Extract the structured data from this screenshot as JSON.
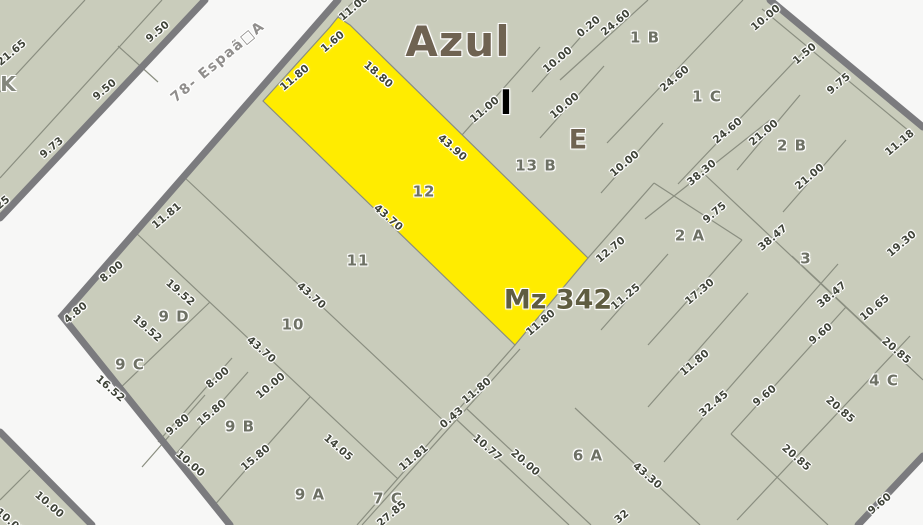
{
  "map": {
    "city_label": "Azul",
    "block_label": "Mz 342",
    "street_name": "78- Espaã□A",
    "highlighted_parcel": "12",
    "colors": {
      "parcel_fill": "#c9ccbb",
      "highlight_parcel": "#ffec00",
      "road_casing": "#7b7b7e",
      "parcel_line": "#8a8e80",
      "street_bg": "#f7f7f6",
      "dimension_text": "#3f4338",
      "title_text": "#6f6352"
    }
  },
  "labels": [
    {
      "name": "city-title",
      "text": "Azul"
    },
    {
      "name": "block-number",
      "text": "Mz 342"
    },
    {
      "name": "street-name",
      "text": "78- Espaã□A"
    },
    {
      "name": "zone-letter-i",
      "text": "I"
    },
    {
      "name": "zone-letter-e",
      "text": "E"
    },
    {
      "name": "zone-letter-k",
      "text": "K"
    },
    {
      "name": "parcel-12",
      "text": "12"
    },
    {
      "name": "parcel-11",
      "text": "11"
    },
    {
      "name": "parcel-10",
      "text": "10"
    },
    {
      "name": "parcel-9d",
      "text": "9 D"
    },
    {
      "name": "parcel-9c",
      "text": "9 C"
    },
    {
      "name": "parcel-9b",
      "text": "9 B"
    },
    {
      "name": "parcel-9a",
      "text": "9 A"
    },
    {
      "name": "parcel-7c",
      "text": "7 C"
    },
    {
      "name": "parcel-6a",
      "text": "6 A"
    },
    {
      "name": "parcel-13b",
      "text": "13 B"
    },
    {
      "name": "parcel-1b",
      "text": "1 B"
    },
    {
      "name": "parcel-1c",
      "text": "1 C"
    },
    {
      "name": "parcel-2b",
      "text": "2 B"
    },
    {
      "name": "parcel-2a",
      "text": "2 A"
    },
    {
      "name": "parcel-3",
      "text": "3"
    },
    {
      "name": "parcel-4c",
      "text": "4 C"
    },
    {
      "name": "dim",
      "text": "9.50"
    },
    {
      "name": "dim",
      "text": "9.50"
    },
    {
      "name": "dim",
      "text": "21.65"
    },
    {
      "name": "dim",
      "text": "9.73"
    },
    {
      "name": "dim",
      "text": "25"
    },
    {
      "name": "dim",
      "text": "11.00"
    },
    {
      "name": "dim",
      "text": "1.60"
    },
    {
      "name": "dim",
      "text": "11.80"
    },
    {
      "name": "dim",
      "text": "18.80"
    },
    {
      "name": "dim",
      "text": "43.90"
    },
    {
      "name": "dim",
      "text": "11.00"
    },
    {
      "name": "dim",
      "text": "10.00"
    },
    {
      "name": "dim",
      "text": "10.00"
    },
    {
      "name": "dim",
      "text": "0.20"
    },
    {
      "name": "dim",
      "text": "24.60"
    },
    {
      "name": "dim",
      "text": "24.60"
    },
    {
      "name": "dim",
      "text": "24.60"
    },
    {
      "name": "dim",
      "text": "10.00"
    },
    {
      "name": "dim",
      "text": "10.00"
    },
    {
      "name": "dim",
      "text": "1.50"
    },
    {
      "name": "dim",
      "text": "9.75"
    },
    {
      "name": "dim",
      "text": "11.18"
    },
    {
      "name": "dim",
      "text": "21.00"
    },
    {
      "name": "dim",
      "text": "21.00"
    },
    {
      "name": "dim",
      "text": "38.30"
    },
    {
      "name": "dim",
      "text": "9.75"
    },
    {
      "name": "dim",
      "text": "38.47"
    },
    {
      "name": "dim",
      "text": "17.30"
    },
    {
      "name": "dim",
      "text": "19.30"
    },
    {
      "name": "dim",
      "text": "38.47"
    },
    {
      "name": "dim",
      "text": "10.65"
    },
    {
      "name": "dim",
      "text": "12.70"
    },
    {
      "name": "dim",
      "text": "11.25"
    },
    {
      "name": "dim",
      "text": "11.80"
    },
    {
      "name": "dim",
      "text": "11.80"
    },
    {
      "name": "dim",
      "text": "32.45"
    },
    {
      "name": "dim",
      "text": "9.60"
    },
    {
      "name": "dim",
      "text": "9.60"
    },
    {
      "name": "dim",
      "text": "9.60"
    },
    {
      "name": "dim",
      "text": "20.85"
    },
    {
      "name": "dim",
      "text": "20.85"
    },
    {
      "name": "dim",
      "text": "20.85"
    },
    {
      "name": "dim",
      "text": "43.70"
    },
    {
      "name": "dim",
      "text": "43.70"
    },
    {
      "name": "dim",
      "text": "43.70"
    },
    {
      "name": "dim",
      "text": "11.81"
    },
    {
      "name": "dim",
      "text": "8.00"
    },
    {
      "name": "dim",
      "text": "4.80"
    },
    {
      "name": "dim",
      "text": "19.52"
    },
    {
      "name": "dim",
      "text": "19.52"
    },
    {
      "name": "dim",
      "text": "16.52"
    },
    {
      "name": "dim",
      "text": "8.00"
    },
    {
      "name": "dim",
      "text": "9.80"
    },
    {
      "name": "dim",
      "text": "15.80"
    },
    {
      "name": "dim",
      "text": "15.80"
    },
    {
      "name": "dim",
      "text": "10.00"
    },
    {
      "name": "dim",
      "text": "14.05"
    },
    {
      "name": "dim",
      "text": "11.80"
    },
    {
      "name": "dim",
      "text": "0.43"
    },
    {
      "name": "dim",
      "text": "11.81"
    },
    {
      "name": "dim",
      "text": "27.85"
    },
    {
      "name": "dim",
      "text": "10.77"
    },
    {
      "name": "dim",
      "text": "20.00"
    },
    {
      "name": "dim",
      "text": "43.30"
    },
    {
      "name": "dim",
      "text": "32"
    },
    {
      "name": "dim",
      "text": "10.00"
    },
    {
      "name": "dim",
      "text": "10.00"
    },
    {
      "name": "dim",
      "text": "10.00"
    }
  ]
}
